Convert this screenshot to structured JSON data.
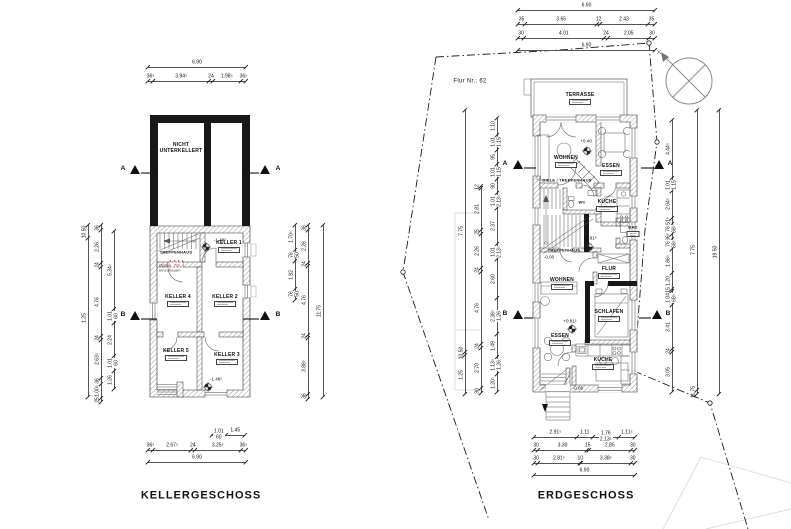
{
  "site": {
    "flur_label": "Flur Nr.: 62"
  },
  "sections": {
    "a": "A",
    "b": "B"
  },
  "plans": {
    "keller": {
      "title": "KELLERGESCHOSS",
      "rooms": {
        "nicht_unterkellert": "NICHT\nUNTERKELLERT",
        "treppenhaus": "TREPPENHAUS",
        "keller1": "KELLER 1",
        "keller2": "KELLER 2",
        "keller3": "KELLER 3",
        "keller4": "KELLER 4",
        "keller5": "KELLER 5"
      },
      "note": "Option. Tür\neinzubauen",
      "levels": {
        "upper": "-1.48⁵",
        "lower": "-1.48⁵"
      },
      "dims": {
        "top_total": [
          "6.90"
        ],
        "top_detail": [
          "36⁵",
          "3.94⁵",
          "24",
          "1.98⁵",
          "36⁵"
        ],
        "bottom_windows": [
          "1.01\n60",
          "1.45"
        ],
        "bottom_detail": [
          "36⁵",
          "2.67⁵",
          "24",
          "3.25⁵",
          "36⁵"
        ],
        "bottom_total": [
          "6.90"
        ],
        "left_outer": [
          "10.50",
          "1.25"
        ],
        "left_mid": [
          "36",
          "2.26",
          "24",
          "4.76",
          "24",
          "2.63⁵",
          "36",
          "1.00⁵",
          "25"
        ],
        "left_inner": [
          "5.34⁵",
          "1.01\n60",
          "2.24",
          "1.01\n60",
          "1.26"
        ],
        "right_inner": [
          "1.70⁵",
          "76\n50",
          "1.92",
          "76\n50"
        ],
        "right_mid": [
          "36",
          "2.26",
          "24",
          "4.76",
          "24",
          "3.88⁵",
          "36"
        ],
        "right_outer": [
          "11.75"
        ]
      }
    },
    "erdgeschoss": {
      "title": "ERDGESCHOSS",
      "rooms": {
        "terrasse": "TERRASSE",
        "wohnen_top": "WOHNEN",
        "essen_top": "ESSEN",
        "diele": "DIELE / TREPPENHAUS",
        "wc": "WC",
        "kueche_top": "KÜCHE",
        "bad": "BAD",
        "treppenhaus": "TREPPENHAUS",
        "flur": "FLUR",
        "wohnen_low": "WOHNEN",
        "schlafen": "SCHLAFEN",
        "essen_low": "ESSEN",
        "kueche_low": "KÜCHE"
      },
      "levels": {
        "wohnen": "+0.40",
        "stair": "+0.81⁵",
        "diele": "-0.00",
        "essen": "+0.81⁵",
        "aussen": "-0.86"
      },
      "dims": {
        "top_total": [
          "6.90"
        ],
        "top_detail1": [
          "35",
          "3.65",
          "12",
          "2.43",
          "35"
        ],
        "top_detail2": [
          "30",
          "4.01",
          "24",
          "2.05",
          "30"
        ],
        "bottom_detail1": [
          "2.91⁵",
          "1.11",
          "1.76\n2.13⁵",
          "1.11⁵"
        ],
        "bottom_detail2": [
          "30",
          "3.30",
          "15",
          "2.85",
          "30"
        ],
        "bottom_detail3": [
          "30",
          "2.81⁵",
          "10",
          "3.38⁵",
          "30"
        ],
        "bottom_total": [
          "6.90"
        ],
        "left_outer": [
          "7.75",
          "10.50",
          "1.25"
        ],
        "left_mid": [
          "12",
          "2.81",
          "25",
          "2.26",
          "24",
          "4.76",
          "24",
          "2.70",
          "30"
        ],
        "left_inner": [
          "1.10",
          "1.01\n1.15",
          "95",
          "1.01\n1.15",
          "90",
          "1.01\n2.13⁵",
          "2.37",
          "1.01\n2.13⁵",
          "2.60",
          "2.38⁵\n1.26",
          "1.49",
          "1.13⁵\n1.26",
          "1.20⁵"
        ],
        "right_inner": [
          "4.44⁵",
          "1.01\n1.15",
          "2.04⁵",
          "51⁵",
          "76\n68⁵",
          "36⁵",
          "76\n68⁵",
          "1.86⁵",
          "1.20",
          "15",
          "1.04\n68⁵",
          "3.41",
          "24",
          "3.05"
        ],
        "right_mid": [
          "7.75",
          "11.75"
        ],
        "right_outer": [
          "19.50"
        ]
      }
    }
  }
}
